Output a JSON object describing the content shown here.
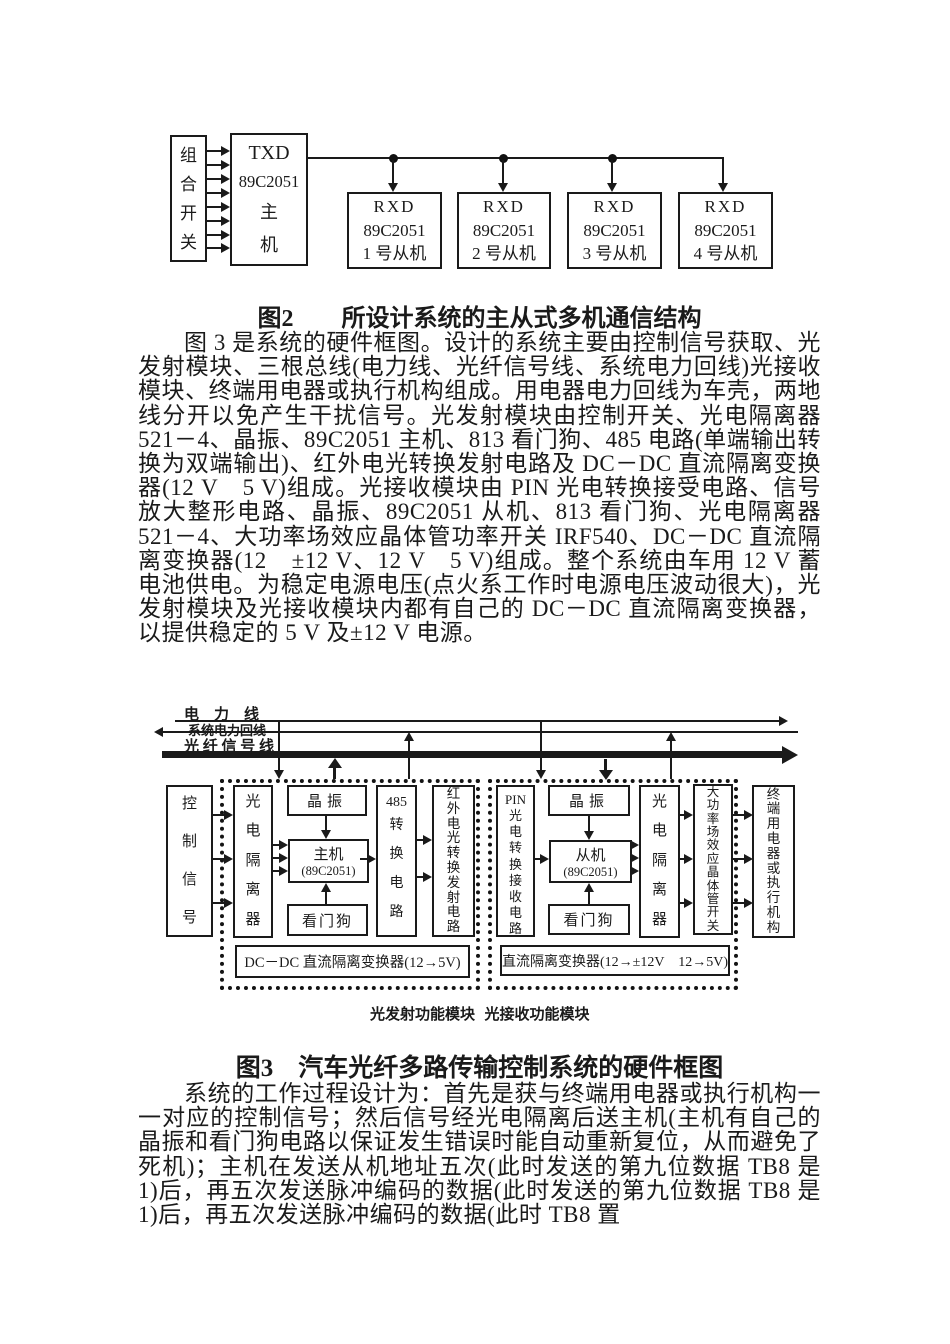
{
  "figure2": {
    "switch_label": "组合开关",
    "master": {
      "l1": "TXD",
      "l2": "89C2051",
      "l3": "主",
      "l4": "机"
    },
    "slaves": [
      {
        "l1": "RXD",
        "l2": "89C2051",
        "l3": "1 号从机"
      },
      {
        "l1": "RXD",
        "l2": "89C2051",
        "l3": "2 号从机"
      },
      {
        "l1": "RXD",
        "l2": "89C2051",
        "l3": "3 号从机"
      },
      {
        "l1": "RXD",
        "l2": "89C2051",
        "l3": "4 号从机"
      }
    ],
    "caption": "图2　　所设计系统的主从式多机通信结构"
  },
  "body": {
    "paragraph1": "图 3 是系统的硬件框图。设计的系统主要由控制信号获取、光发射模块、三根总线(电力线、光纤信号线、系统电力回线)光接收模块、终端用电器或执行机构组成。用电器电力回线为车壳，两地线分开以免产生干扰信号。光发射模块由控制开关、光电隔离器 521－4、晶振、89C2051 主机、813 看门狗、485 电路(单端输出转换为双端输出)、红外电光转换发射电路及 DC－DC 直流隔离变换器(12 V　5 V)组成。光接收模块由 PIN 光电转换接受电路、信号放大整形电路、晶振、89C2051 从机、813 看门狗、光电隔离器 521－4、大功率场效应晶体管功率开关 IRF540、DC－DC 直流隔离变换器(12　±12 V、12 V　5 V)组成。整个系统由车用 12 V 蓄电池供电。为稳定电源电压(点火系工作时电源电压波动很大)，光发射模块及光接收模块内都有自己的 DC－DC 直流隔离变换器，以提供稳定的 5 V 及±12 V 电源。",
    "paragraph2": "系统的工作过程设计为：首先是获与终端用电器或执行机构一一对应的控制信号；然后信号经光电隔离后送主机(主机有自己的晶振和看门狗电路以保证发生错误时能自动重新复位，从而避免了死机)；主机在发送从机地址五次(此时发送的第九位数据 TB8 是 1)后，再五次发送脉冲编码的数据(此时发送的第九位数据 TB8 是 1)后，再五次发送脉冲编码的数据(此时 TB8 置"
  },
  "figure3": {
    "bus": {
      "power_label": "电　力　线",
      "return_label": "系统电力回线",
      "fiber_label": "光 纤 信 号 线"
    },
    "left": {
      "control_signal": "控制信号",
      "opto_isolator": "光电隔离器",
      "crystal": "晶振",
      "master_l1": "主机",
      "master_l2": "(89C2051)",
      "watchdog": "看门狗",
      "conv485_l1": "485",
      "conv485_l2": "转换电路",
      "ir_transmit": "红外电光转换发射电路",
      "dc_bar": "DC－DC 直流隔离变换器(12→5V)",
      "caption": "光发射功能模块"
    },
    "right": {
      "pin_l1": "PIN",
      "pin_l2": "光电转换接收电路",
      "crystal": "晶振",
      "slave_l1": "从机",
      "slave_l2": "(89C2051)",
      "watchdog": "看门狗",
      "opto_isolator": "光电隔离器",
      "mosfet_switch": "大功率场效应晶体管开关",
      "terminal": "终端用电器或执行机构",
      "dc_bar": "直流隔离变换器(12→±12V　12→5V)",
      "caption": "光接收功能模块"
    },
    "caption": "图3　汽车光纤多路传输控制系统的硬件框图"
  }
}
